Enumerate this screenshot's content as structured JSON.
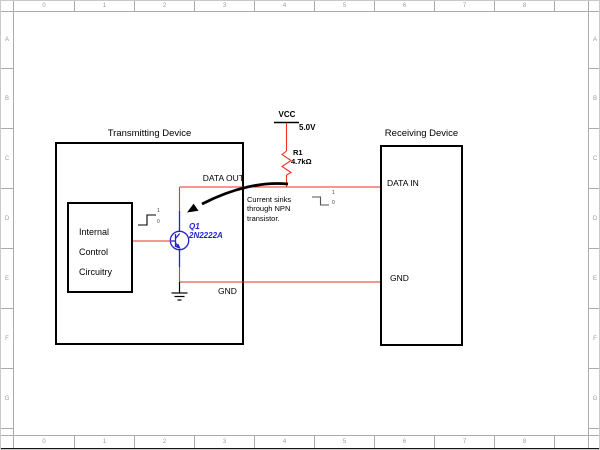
{
  "colors": {
    "wire": "#ee3124",
    "component": "#2323cc",
    "ink": "#000000",
    "ruler_line": "#ababab",
    "ruler_text": "#9b9b9b",
    "frame_bar": "#161616"
  },
  "rulers": {
    "columns": [
      "0",
      "1",
      "2",
      "3",
      "4",
      "5",
      "6",
      "7",
      "8"
    ],
    "rows": [
      "A",
      "B",
      "C",
      "D",
      "E",
      "F",
      "G"
    ]
  },
  "labels": {
    "transmitting_title": "Transmitting Device",
    "receiving_title": "Receiving Device",
    "internal_line1": "Internal",
    "internal_line2": "Control",
    "internal_line3": "Circuitry",
    "data_out": "DATA OUT",
    "data_in": "DATA IN",
    "gnd_tx": "GND",
    "gnd_rx": "GND",
    "vcc": "VCC",
    "vcc_voltage": "5.0V",
    "resistor_ref": "R1",
    "resistor_value": "4.7kΩ",
    "transistor_ref": "Q1",
    "transistor_part": "2N2222A",
    "annotation_line1": "Current sinks",
    "annotation_line2": "through NPN",
    "annotation_line3": "transistor.",
    "logic_high": "1",
    "logic_low": "0"
  }
}
